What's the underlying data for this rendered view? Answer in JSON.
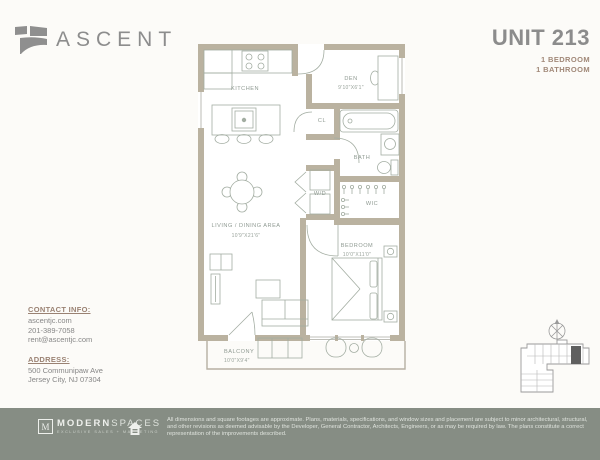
{
  "brand": {
    "name": "ASCENT"
  },
  "unit": {
    "title": "UNIT 213",
    "bedrooms": "1 BEDROOM",
    "bathrooms": "1 BATHROOM"
  },
  "floorplan": {
    "wall_color": "#bab2a0",
    "line_color": "#a3ada2",
    "rooms": {
      "kitchen": {
        "label": "KITCHEN"
      },
      "den": {
        "label": "DEN",
        "dims": "9'10\"X6'1\""
      },
      "closet": {
        "label": "CL"
      },
      "bath": {
        "label": "BATH"
      },
      "washer_dryer": {
        "label": "W/D"
      },
      "wic": {
        "label": "WIC"
      },
      "living_dining": {
        "label": "LIVING / DINING AREA",
        "dims": "10'9\"X21'6\""
      },
      "bedroom": {
        "label": "BEDROOM",
        "dims": "10'0\"X11'0\""
      },
      "balcony": {
        "label": "BALCONY",
        "dims": "10'0\"X9'4\""
      }
    }
  },
  "contact": {
    "heading": "CONTACT INFO:",
    "website": "ascentjc.com",
    "phone": "201-389-7058",
    "email": "rent@ascentjc.com"
  },
  "address": {
    "heading": "ADDRESS:",
    "line1": "500 Communipaw Ave",
    "line2": "Jersey City, NJ 07304"
  },
  "footer": {
    "bg": "#868d84",
    "logo": {
      "initial": "M",
      "name_bold": "MODERN",
      "name_light": "SPACES",
      "tagline": "EXCLUSIVE SALES + MARKETING"
    },
    "disclaimer_line1": "All dimensions and square footages are approximate. Plans, materials, specifications, and window sizes and placement are subject to minor architectural, structural,",
    "disclaimer_line2": "and other revisions as deemed advisable by the Developer, General Contractor, Architects, Engineers, or as may be required by law. The plans constitute a correct",
    "disclaimer_line3": "representation of the improvements described."
  }
}
